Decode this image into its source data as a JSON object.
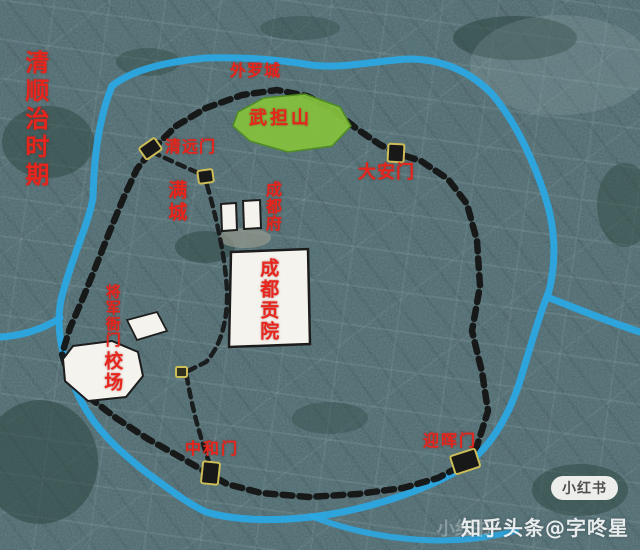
{
  "labels": {
    "era_title": "清顺治时期",
    "outer_wall": "外罗城",
    "wudan_hill": "武担山",
    "gate_qingyuan": "清远门",
    "manchu_city": "满城",
    "chengdu_prefecture": "成都府",
    "gate_daan": "大安门",
    "examination_hall": "成都贡院",
    "general_yamen": "将军衙门",
    "drill_ground": "校场",
    "gate_zhonghe": "中和门",
    "gate_yinghui": "迎晖门"
  },
  "watermarks": {
    "badge": "小红书",
    "credit": "知乎头条@字咚星",
    "ghost": "小红书"
  },
  "colors": {
    "label_red": "#e8251c",
    "river_blue": "#2ba7e2",
    "wall_black": "#141414",
    "hill_green": "#85c23d",
    "hill_edge": "#4f8f1f",
    "marker_border": "#cdbd58",
    "marker_fill": "#181818",
    "building_white": "#f5f3ee",
    "building_edge": "#1c1c1c"
  }
}
